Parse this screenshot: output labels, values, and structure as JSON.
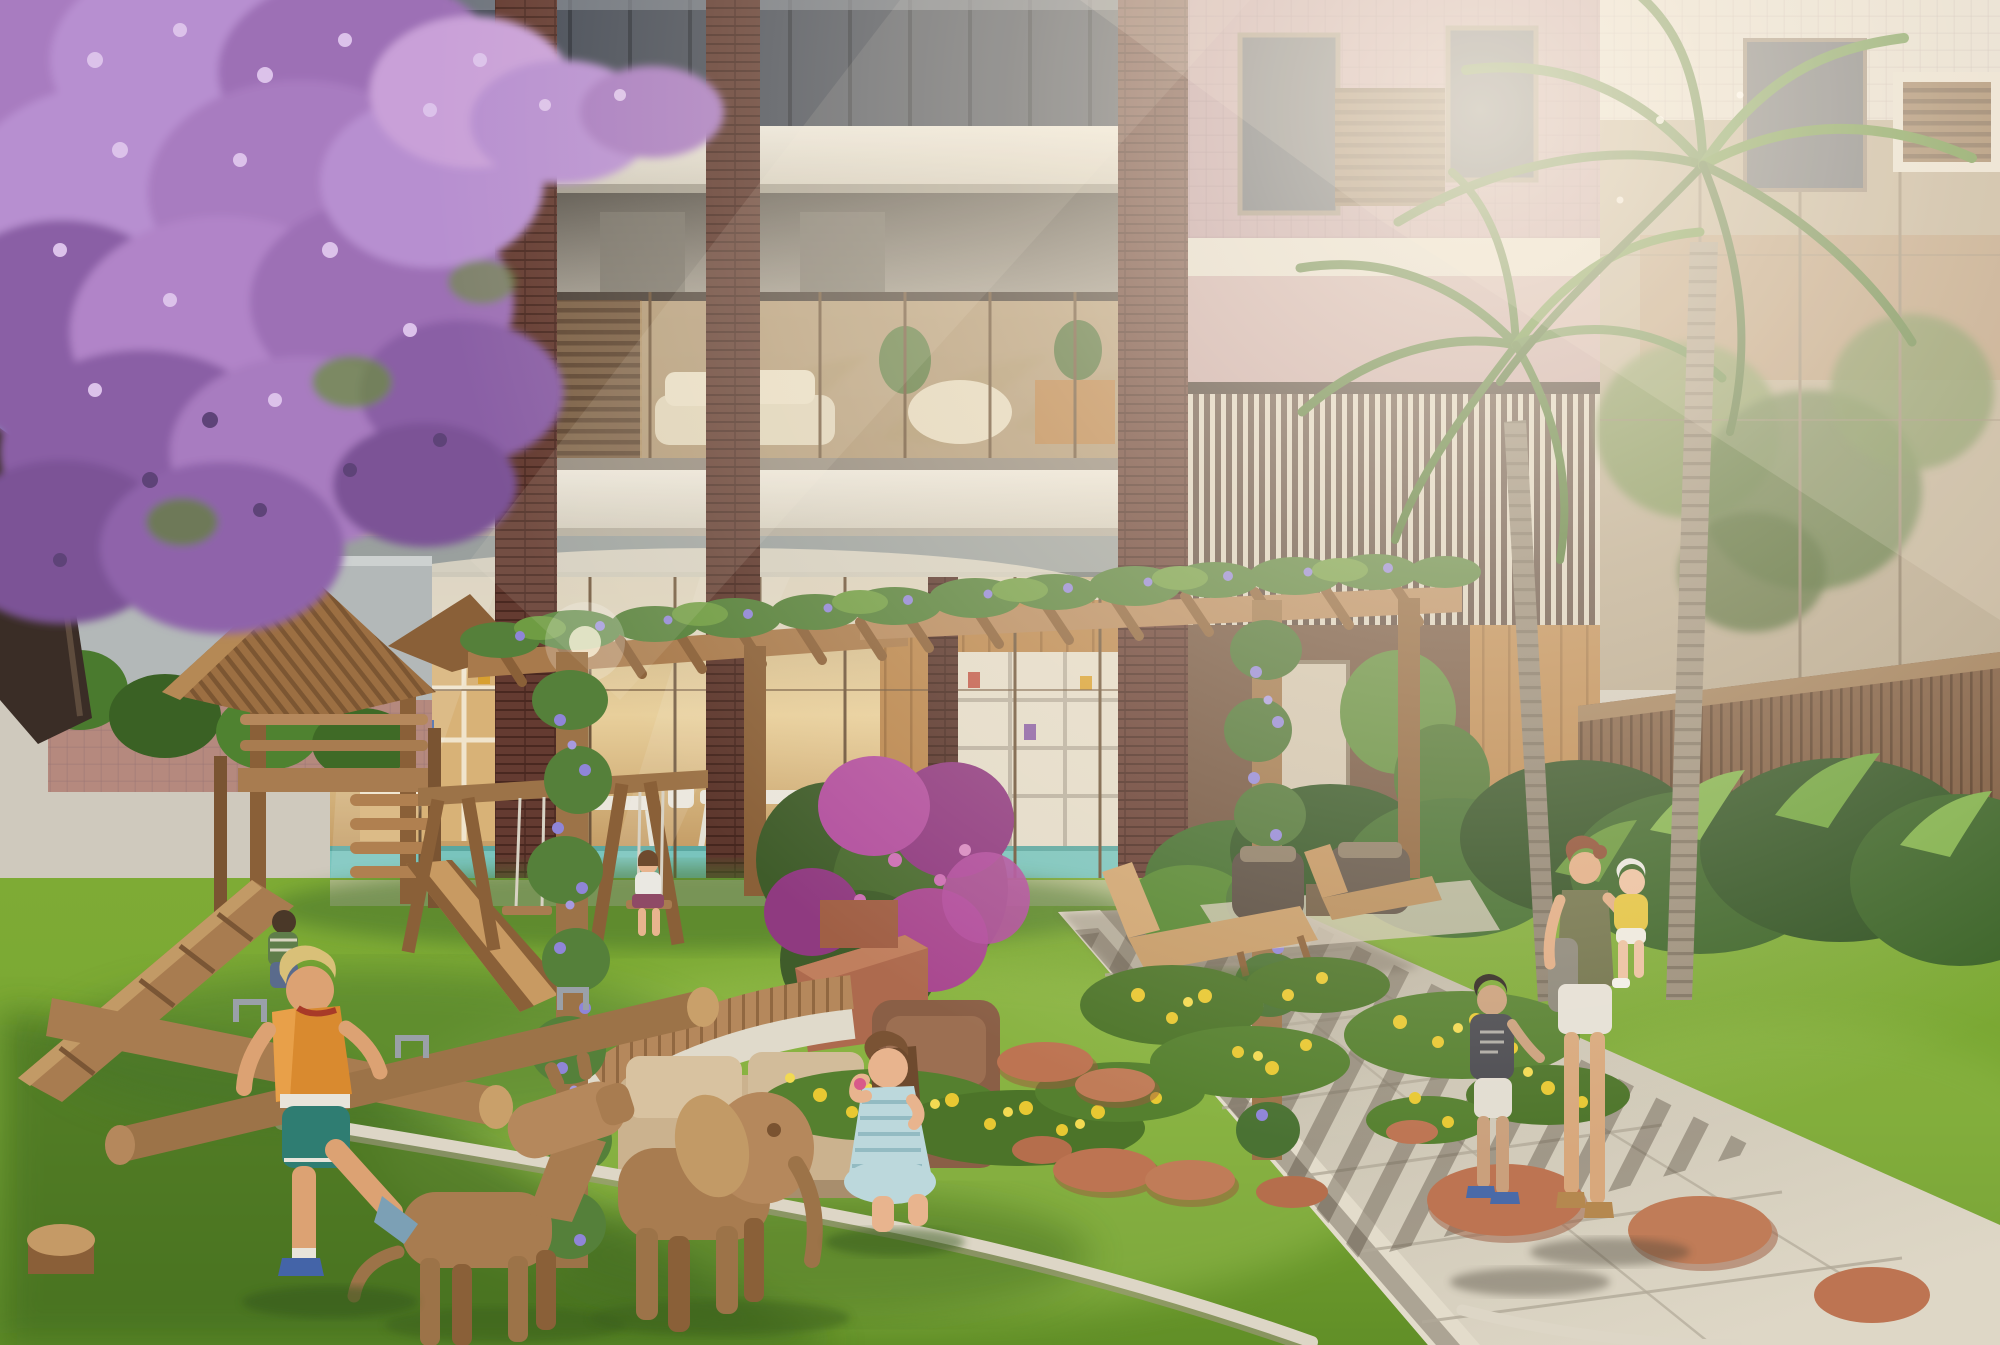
{
  "image": {
    "kind": "architectural-exterior-rendering",
    "width_px": 2000,
    "height_px": 1345
  },
  "scene": {
    "description": "Sunlit residential courtyard rendering: purple jacaranda tree at left, modern apartment building with brick columns and double-height glass atrium, two royal palms, timber pergola covered in flowering vines, wooden playground with playhouse, slide, swings and log seesaw, wooden dog and elephant sculptures, children playing on the lawn, and a mother with two children on a concrete walkway among yellow flower beds and terracotta stepping stones.",
    "time_of_day": "late-afternoon golden light",
    "building": {
      "elements": [
        "upper-floor dark glazing",
        "white concrete slabs",
        "balcony with glass railing",
        "timber louver panels",
        "brick tile columns",
        "double-height glass atrium with lounge and kids club",
        "rose tile facade wing",
        "vertical slat screen",
        "glass wall reflecting trees",
        "timber fence"
      ]
    },
    "landscape": {
      "elements": [
        "jacaranda canopy",
        "royal palm pair",
        "distant palm fronds",
        "boundary wall",
        "shrub border",
        "lawn mound",
        "yellow flower drifts",
        "terracotta stepping stones",
        "stone lawn edging",
        "concrete walkway with shadow stripes",
        "bougainvillea",
        "vine-wrapped pergola posts",
        "curved wooden bench with planter",
        "sun loungers",
        "outdoor armchairs"
      ]
    },
    "play_equipment": [
      "timber playhouse with corrugated roof",
      "wooden slide",
      "climbing ramp",
      "swing set",
      "crossed-log seesaw",
      "cut log stool",
      "wooden dog sculpture",
      "wooden elephant sculpture"
    ],
    "people": [
      "boy running in orange shirt",
      "girl kneeling blowing bubbles",
      "girl on swing",
      "boy sitting on playhouse platform",
      "boy walking on path",
      "mother carrying toddler girl"
    ]
  },
  "palette": {
    "sky": "#8fb2d4",
    "slab_light": "#e6e1d6",
    "slab_shadow": "#a8a296",
    "soffit_dark": "#6e6961",
    "glass_sky": "#7d90aa",
    "glass_warm": "#d9c192",
    "brick_dark": "#643b31",
    "rose_tile": "#b5929c",
    "louver_wood": "#7c6147",
    "slat_cream": "#d9d1c0",
    "atrium_wood": "#b9854c",
    "pool_aqua": "#79c4bd",
    "jacaranda_main": "#b78fd0",
    "jacaranda_deep": "#7c5296",
    "jacaranda_light": "#dcc2ea",
    "palm_green": "#4f7a35",
    "palm_trunk": "#9a8d7a",
    "grass_sun": "#8fbc4a",
    "grass_mid": "#6f9d2f",
    "grass_shade": "#3f6a22",
    "pergola_wood": "#a87c50",
    "wood_light": "#c29a66",
    "wood_dark": "#7a5331",
    "vine_flower": "#8f85d8",
    "bougainvillea": "#b24f9e",
    "flower_yellow": "#e8c832",
    "path_concrete": "#d2cbbb",
    "stepping_stone": "#bd7452",
    "edging_stone": "#ddd6c6",
    "shirt_orange": "#d98a2f",
    "shorts_teal": "#2f7d72",
    "dress_blue": "#bcd8dc",
    "top_olive": "#6e7048",
    "glare_warm": "#fff7e8"
  }
}
